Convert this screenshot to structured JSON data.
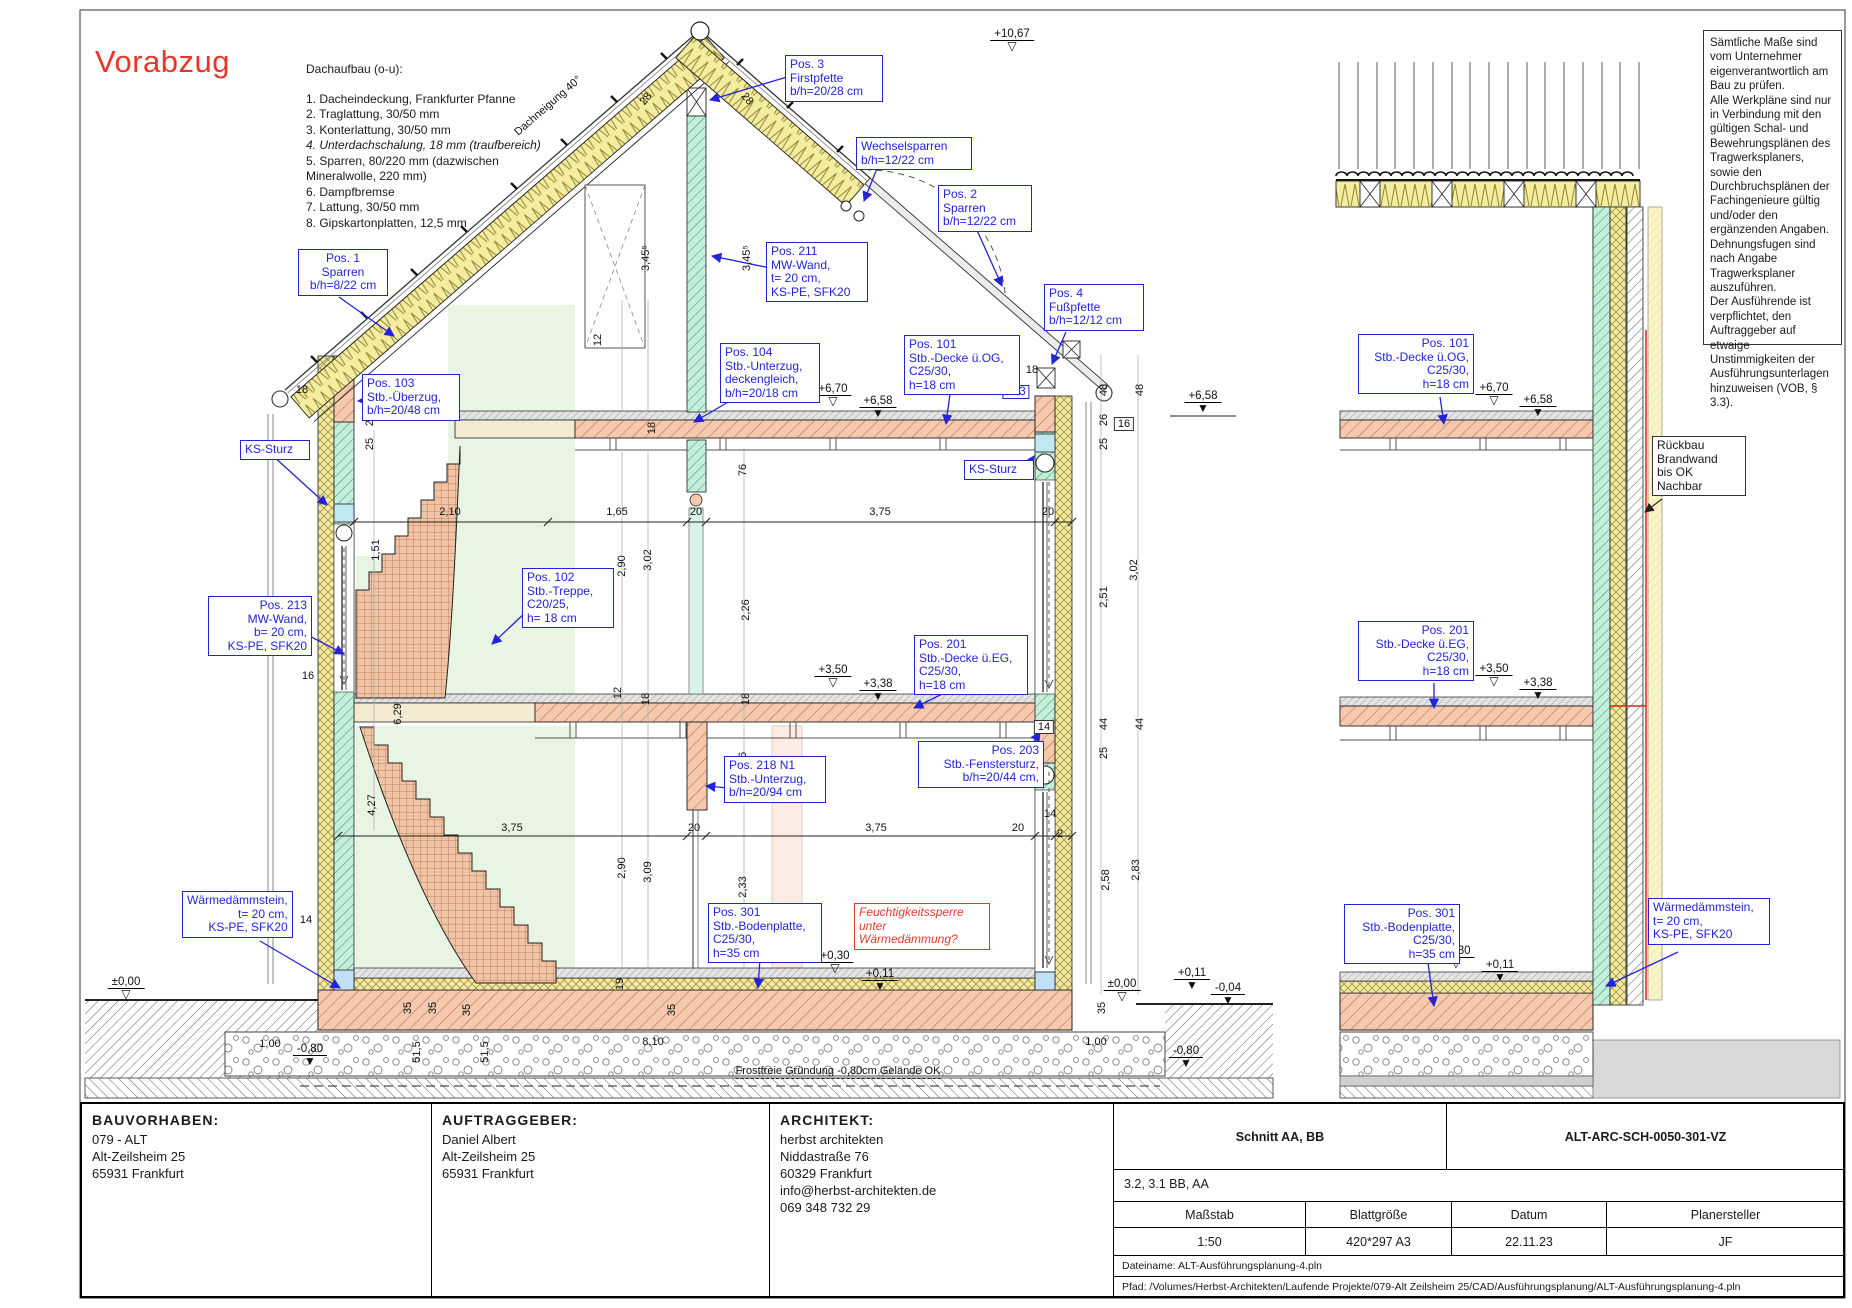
{
  "colors": {
    "label_blue": "#2323d8",
    "warn_red": "#e03a2e",
    "insulation_yellow": "#f1eaa6",
    "wall_green": "#c3eeda",
    "concrete_pink": "#f5c9ae",
    "room_pale_green": "#e9f5e3"
  },
  "stamp": "Vorabzug",
  "roof_buildup": {
    "title": "Dachaufbau (o-u):",
    "italic_item": 3,
    "items": [
      "1. Dacheindeckung, Frankfurter Pfanne",
      "2. Traglattung, 30/50 mm",
      "3. Konterlattung, 30/50 mm",
      "4. Unterdachschalung, 18 mm (traufbereich)",
      "5. Sparren, 80/220 mm (dazwischen",
      "Mineralwolle, 220 mm)",
      "6. Dampfbremse",
      "7. Lattung, 30/50 mm",
      "8. Gipskartonplatten, 12,5 mm"
    ]
  },
  "notes": "Sämtliche Maße sind vom Unternehmer eigenverantwortlich am Bau zu prüfen.\nAlle Werkpläne sind nur in Verbindung mit den gültigen Schal- und Bewehrungsplänen des Tragwerksplaners, sowie den Durchbruchsplänen der Fachingenieure gültig und/oder den ergänzenden Angaben.\nDehnungsfugen sind nach Angabe Tragwerksplaner auszuführen.\nDer Ausführende ist verpflichtet, den Auftraggeber auf etwaige Unstimmigkeiten der Ausführungsunterlagen hinzuweisen (VOB, § 3.3).",
  "annotations": [
    {
      "name": "label-pos1-sparren",
      "x": 298,
      "y": 249,
      "w": 80,
      "al": "c",
      "c": "blue",
      "lines": [
        "Pos. 1",
        "Sparren",
        "b/h=8/22 cm"
      ]
    },
    {
      "name": "label-pos3-firstpfette",
      "x": 785,
      "y": 55,
      "w": 88,
      "al": "l",
      "c": "blue",
      "lines": [
        "Pos. 3",
        "Firstpfette",
        "b/h=20/28 cm"
      ]
    },
    {
      "name": "label-wechselsparren",
      "x": 856,
      "y": 137,
      "w": 106,
      "al": "l",
      "c": "blue",
      "lines": [
        "Wechselsparren",
        "b/h=12/22 cm"
      ]
    },
    {
      "name": "label-pos2-sparren",
      "x": 938,
      "y": 185,
      "w": 84,
      "al": "l",
      "c": "blue",
      "lines": [
        "Pos. 2",
        "Sparren",
        "b/h=12/22 cm"
      ]
    },
    {
      "name": "label-pos4-fusspfette",
      "x": 1044,
      "y": 284,
      "w": 90,
      "al": "l",
      "c": "blue",
      "lines": [
        "Pos. 4",
        "Fußpfette",
        "b/h=12/12 cm"
      ]
    },
    {
      "name": "label-pos211-mw-wand",
      "x": 766,
      "y": 242,
      "w": 92,
      "al": "l",
      "c": "blue",
      "lines": [
        "Pos. 211",
        "MW-Wand,",
        "t= 20 cm,",
        "KS-PE, SFK20"
      ]
    },
    {
      "name": "label-pos103-ueberzug",
      "x": 362,
      "y": 374,
      "w": 88,
      "al": "l",
      "c": "blue",
      "lines": [
        "Pos. 103",
        "Stb.-Überzug,",
        "b/h=20/48 cm"
      ]
    },
    {
      "name": "label-ks-sturz-left",
      "x": 240,
      "y": 440,
      "w": 60,
      "al": "l",
      "c": "blue",
      "lines": [
        "KS-Sturz"
      ]
    },
    {
      "name": "label-pos104-unterzug",
      "x": 720,
      "y": 343,
      "w": 90,
      "al": "l",
      "c": "blue",
      "lines": [
        "Pos. 104",
        "Stb.-Unterzug,",
        "deckengleich,",
        "b/h=20/18 cm"
      ]
    },
    {
      "name": "label-pos101-decke-og",
      "x": 904,
      "y": 335,
      "w": 106,
      "al": "l",
      "c": "blue",
      "lines": [
        "Pos. 101",
        "Stb.-Decke ü.OG,",
        "C25/30,",
        "h=18 cm"
      ]
    },
    {
      "name": "label-ks-sturz-right",
      "x": 964,
      "y": 460,
      "w": 60,
      "al": "l",
      "c": "blue",
      "lines": [
        "KS-Sturz"
      ]
    },
    {
      "name": "label-pos213-mw-wand",
      "x": 208,
      "y": 596,
      "w": 94,
      "al": "r",
      "c": "blue",
      "lines": [
        "Pos. 213",
        "MW-Wand,",
        "b= 20 cm,",
        "KS-PE, SFK20"
      ]
    },
    {
      "name": "label-pos102-treppe",
      "x": 522,
      "y": 568,
      "w": 82,
      "al": "l",
      "c": "blue",
      "lines": [
        "Pos. 102",
        "Stb.-Treppe,",
        "C20/25,",
        "h= 18 cm"
      ]
    },
    {
      "name": "label-pos201-decke-eg",
      "x": 914,
      "y": 635,
      "w": 104,
      "al": "l",
      "c": "blue",
      "lines": [
        "Pos. 201",
        "Stb.-Decke ü.EG,",
        "C25/30,",
        "h=18 cm"
      ]
    },
    {
      "name": "label-pos203-fenstersturz",
      "x": 918,
      "y": 741,
      "w": 116,
      "al": "r",
      "c": "blue",
      "lines": [
        "Pos. 203",
        "Stb.-Fenstersturz,",
        "b/h=20/44 cm,"
      ]
    },
    {
      "name": "label-pos218-unterzug",
      "x": 724,
      "y": 756,
      "w": 92,
      "al": "l",
      "c": "blue",
      "lines": [
        "Pos. 218 N1",
        "Stb.-Unterzug,",
        "b/h=20/94 cm"
      ]
    },
    {
      "name": "label-pos301-bodenplatte",
      "x": 708,
      "y": 903,
      "w": 104,
      "al": "l",
      "c": "blue",
      "lines": [
        "Pos. 301",
        "Stb.-Bodenplatte,",
        "C25/30,",
        "h=35 cm"
      ]
    },
    {
      "name": "label-feuchtigkeitssperre",
      "x": 854,
      "y": 903,
      "w": 126,
      "al": "l",
      "c": "red",
      "lines": [
        "Feuchtigkeitssperre",
        "unter",
        "Wärmedämmung?"
      ]
    },
    {
      "name": "label-waermedaemmstein-left",
      "x": 182,
      "y": 891,
      "w": 100,
      "al": "r",
      "c": "blue",
      "lines": [
        "Wärmedämmstein,",
        "t= 20 cm,",
        "KS-PE, SFK20"
      ]
    },
    {
      "name": "label-pos101-decke-og-right",
      "x": 1358,
      "y": 334,
      "w": 106,
      "al": "r",
      "c": "blue",
      "lines": [
        "Pos. 101",
        "Stb.-Decke ü.OG,",
        "C25/30,",
        "h=18 cm"
      ]
    },
    {
      "name": "label-pos201-decke-eg-right",
      "x": 1358,
      "y": 621,
      "w": 106,
      "al": "r",
      "c": "blue",
      "lines": [
        "Pos. 201",
        "Stb.-Decke ü.EG,",
        "C25/30,",
        "h=18 cm"
      ]
    },
    {
      "name": "label-pos301-bodenplatte-right",
      "x": 1344,
      "y": 904,
      "w": 106,
      "al": "r",
      "c": "blue",
      "lines": [
        "Pos. 301",
        "Stb.-Bodenplatte,",
        "C25/30,",
        "h=35 cm"
      ]
    },
    {
      "name": "label-waermedaemmstein-right",
      "x": 1648,
      "y": 898,
      "w": 112,
      "al": "l",
      "c": "blue",
      "lines": [
        "Wärmedämmstein,",
        "t= 20 cm,",
        "KS-PE, SFK20"
      ]
    },
    {
      "name": "label-rueckbau-brandwand",
      "x": 1652,
      "y": 436,
      "w": 84,
      "al": "l",
      "c": "black",
      "lines": [
        "Rückbau",
        "Brandwand",
        "bis OK",
        "Nachbar"
      ]
    }
  ],
  "levels": [
    {
      "t": "+10,67",
      "x": 1012,
      "y": 28,
      "f": false
    },
    {
      "t": "+6,70",
      "x": 833,
      "y": 383,
      "f": false
    },
    {
      "t": "+6,58",
      "x": 878,
      "y": 395,
      "f": true
    },
    {
      "t": "+3,50",
      "x": 833,
      "y": 664,
      "f": false
    },
    {
      "t": "+3,38",
      "x": 878,
      "y": 678,
      "f": true
    },
    {
      "t": "+0,30",
      "x": 835,
      "y": 950,
      "f": false
    },
    {
      "t": "+0,11",
      "x": 880,
      "y": 968,
      "f": true
    },
    {
      "t": "±0,00",
      "x": 126,
      "y": 976,
      "f": false
    },
    {
      "t": "±0,00",
      "x": 1122,
      "y": 978,
      "f": false
    },
    {
      "t": "+0,11",
      "x": 1192,
      "y": 967,
      "f": true
    },
    {
      "t": "-0,04",
      "x": 1228,
      "y": 982,
      "f": true
    },
    {
      "t": "-0,80",
      "x": 310,
      "y": 1043,
      "f": true
    },
    {
      "t": "-0,80",
      "x": 1186,
      "y": 1045,
      "f": true
    },
    {
      "t": "+6,58",
      "x": 1203,
      "y": 390,
      "f": true
    },
    {
      "t": "+6,70",
      "x": 1494,
      "y": 382,
      "f": false
    },
    {
      "t": "+6,58",
      "x": 1538,
      "y": 394,
      "f": true
    },
    {
      "t": "+3,50",
      "x": 1494,
      "y": 663,
      "f": false
    },
    {
      "t": "+3,38",
      "x": 1538,
      "y": 677,
      "f": true
    },
    {
      "t": "+0,30",
      "x": 1456,
      "y": 945,
      "f": false
    },
    {
      "t": "+0,11",
      "x": 1500,
      "y": 959,
      "f": true
    }
  ],
  "dims": [
    {
      "t": "2,10",
      "x": 450,
      "y": 512
    },
    {
      "t": "1,65",
      "x": 617,
      "y": 512
    },
    {
      "t": "20",
      "x": 696,
      "y": 512
    },
    {
      "t": "3,75",
      "x": 880,
      "y": 512
    },
    {
      "t": "20",
      "x": 1048,
      "y": 512
    },
    {
      "t": "3,75",
      "x": 512,
      "y": 828
    },
    {
      "t": "20",
      "x": 694,
      "y": 828
    },
    {
      "t": "3,75",
      "x": 876,
      "y": 828
    },
    {
      "t": "20",
      "x": 1018,
      "y": 828
    },
    {
      "t": "14",
      "x": 1050,
      "y": 814
    },
    {
      "t": "2",
      "x": 1060,
      "y": 834
    },
    {
      "t": "26",
      "x": 370,
      "y": 420,
      "r": -90
    },
    {
      "t": "25",
      "x": 370,
      "y": 444,
      "r": -90
    },
    {
      "t": "1,51",
      "x": 376,
      "y": 550,
      "r": -90
    },
    {
      "t": "6,29",
      "x": 398,
      "y": 714,
      "r": -90
    },
    {
      "t": "4,27",
      "x": 372,
      "y": 805,
      "r": -90
    },
    {
      "t": "18",
      "x": 302,
      "y": 390
    },
    {
      "t": "16",
      "x": 308,
      "y": 676
    },
    {
      "t": "14",
      "x": 306,
      "y": 920
    },
    {
      "t": "48",
      "x": 1104,
      "y": 390,
      "r": -90
    },
    {
      "t": "48",
      "x": 1140,
      "y": 390,
      "r": -90
    },
    {
      "t": "26",
      "x": 1104,
      "y": 420,
      "r": -90
    },
    {
      "t": "25",
      "x": 1104,
      "y": 444,
      "r": -90
    },
    {
      "t": "2,51",
      "x": 1104,
      "y": 597,
      "r": -90
    },
    {
      "t": "3,02",
      "x": 1134,
      "y": 570,
      "r": -90
    },
    {
      "t": "44",
      "x": 1104,
      "y": 724,
      "r": -90
    },
    {
      "t": "44",
      "x": 1140,
      "y": 724,
      "r": -90
    },
    {
      "t": "25",
      "x": 1104,
      "y": 753,
      "r": -90
    },
    {
      "t": "2,58",
      "x": 1106,
      "y": 880,
      "r": -90
    },
    {
      "t": "2,83",
      "x": 1136,
      "y": 870,
      "r": -90
    },
    {
      "t": "28",
      "x": 646,
      "y": 99,
      "r": -50
    },
    {
      "t": "28",
      "x": 747,
      "y": 99,
      "r": 50
    },
    {
      "t": "3,45⁵",
      "x": 646,
      "y": 258,
      "r": -90
    },
    {
      "t": "3,45⁵",
      "x": 747,
      "y": 258,
      "r": -90
    },
    {
      "t": "12",
      "x": 618,
      "y": 693,
      "r": -90
    },
    {
      "t": "18",
      "x": 646,
      "y": 699,
      "r": -90
    },
    {
      "t": "18",
      "x": 746,
      "y": 699,
      "r": -90
    },
    {
      "t": "18",
      "x": 652,
      "y": 428,
      "r": -90
    },
    {
      "t": "12",
      "x": 598,
      "y": 340,
      "r": -90
    },
    {
      "t": "2,90",
      "x": 622,
      "y": 566,
      "r": -90
    },
    {
      "t": "3,02",
      "x": 648,
      "y": 560,
      "r": -90
    },
    {
      "t": "2,26",
      "x": 746,
      "y": 610,
      "r": -90
    },
    {
      "t": "76",
      "x": 743,
      "y": 470,
      "r": -90
    },
    {
      "t": "76",
      "x": 743,
      "y": 758,
      "r": -90
    },
    {
      "t": "2,33",
      "x": 743,
      "y": 887,
      "r": -90
    },
    {
      "t": "2,90",
      "x": 622,
      "y": 868,
      "r": -90
    },
    {
      "t": "3,09",
      "x": 648,
      "y": 872,
      "r": -90
    },
    {
      "t": "19",
      "x": 620,
      "y": 984,
      "r": -90
    },
    {
      "t": "35",
      "x": 408,
      "y": 1008,
      "r": -90
    },
    {
      "t": "35",
      "x": 433,
      "y": 1008,
      "r": -90
    },
    {
      "t": "35",
      "x": 467,
      "y": 1010,
      "r": -90
    },
    {
      "t": "35",
      "x": 672,
      "y": 1010,
      "r": -90
    },
    {
      "t": "35",
      "x": 1102,
      "y": 1008,
      "r": -90
    },
    {
      "t": "51,5",
      "x": 417,
      "y": 1052,
      "r": -90
    },
    {
      "t": "51,5",
      "x": 485,
      "y": 1052,
      "r": -90
    },
    {
      "t": "1,00",
      "x": 270,
      "y": 1044
    },
    {
      "t": "8,10",
      "x": 653,
      "y": 1042
    },
    {
      "t": "1,00",
      "x": 1096,
      "y": 1042
    },
    {
      "t": "18",
      "x": 1032,
      "y": 370
    },
    {
      "t": "103",
      "x": 1016,
      "y": 392,
      "cls": "boxB"
    },
    {
      "t": "16",
      "x": 1124,
      "y": 424,
      "cls": "boxK"
    },
    {
      "t": "14",
      "x": 1044,
      "y": 727,
      "cls": "boxK"
    }
  ],
  "misc": [
    {
      "t": "Dachneigung 40°",
      "x": 548,
      "y": 106,
      "r": -41,
      "cls": ""
    },
    {
      "t": "Frostfreie Gründung -0,80cm Gelände OK",
      "x": 838,
      "y": 1072,
      "r": 0,
      "cls": "frost"
    }
  ],
  "titleblock": {
    "bauvorhaben": {
      "label": "BAUVORHABEN:",
      "l1": "079 - ALT",
      "l2": "Alt-Zeilsheim 25",
      "l3": "65931 Frankfurt"
    },
    "auftraggeber": {
      "label": "AUFTRAGGEBER:",
      "l1": "Daniel Albert",
      "l2": "Alt-Zeilsheim 25",
      "l3": "65931 Frankfurt"
    },
    "architekt": {
      "label": "ARCHITEKT:",
      "l1": "herbst architekten",
      "l2": "Niddastraße 76",
      "l3": "60329 Frankfurt",
      "l4": "info@herbst-architekten.de",
      "l5": "069 348 732 29"
    },
    "sheet_title": "Schnitt AA, BB",
    "sheet_code": "ALT-ARC-SCH-0050-301-VZ",
    "sub_title": "3.2, 3.1 BB, AA",
    "col1_label": "Maßstab",
    "col1_value": "1:50",
    "col2_label": "Blattgröße",
    "col2_value": "420*297 A3",
    "col3_label": "Datum",
    "col3_value": "22.11.23",
    "col4_label": "Planersteller",
    "col4_value": "JF",
    "datei": "Dateiname: ALT-Ausführungsplanung-4.pln",
    "pfad": "Pfad: /Volumes/Herbst-Architekten/Laufende Projekte/079-Alt Zeilsheim 25/CAD/Ausführungsplanung/ALT-Ausführungsplanung-4.pln"
  }
}
